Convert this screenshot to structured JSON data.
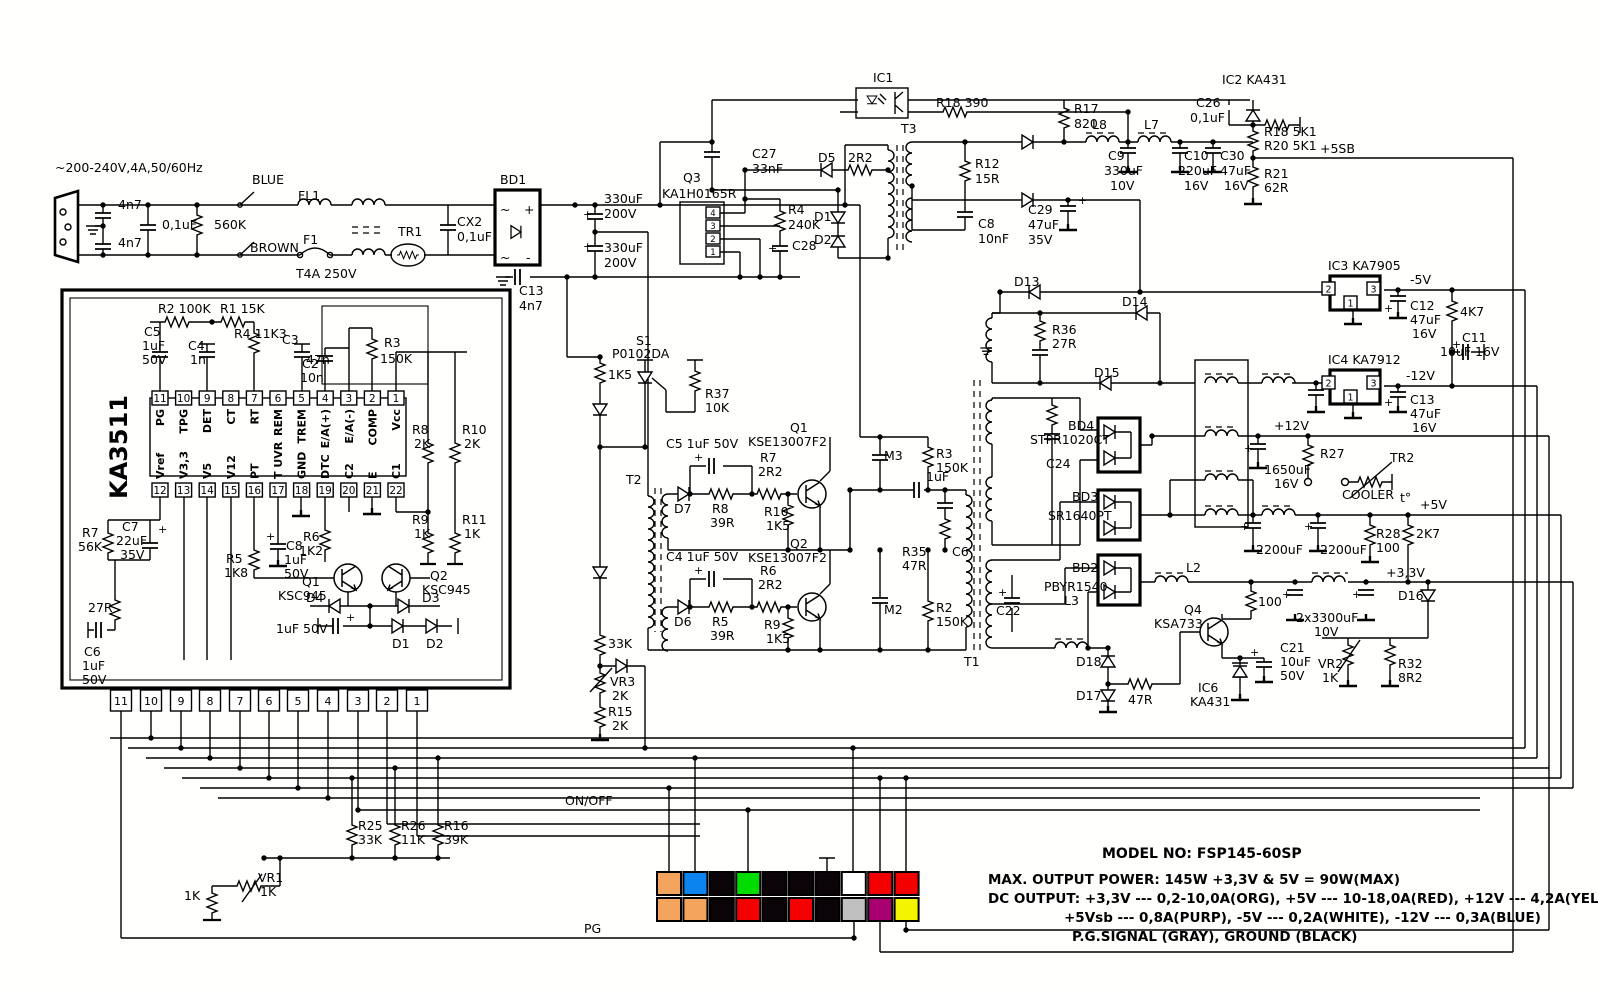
{
  "title": "FSP145-60SP switching power supply schematic",
  "colors": {
    "line": "#000000",
    "background": "#fffffe",
    "orange": "#F4A45C",
    "blue": "#0B84F0",
    "black": "#0A0408",
    "green": "#00DC00",
    "white": "#FFFFFF",
    "red": "#F40000",
    "gray": "#C0C0C0",
    "purple": "#A8006E",
    "yellow": "#F4F400"
  },
  "ka3511": {
    "part": "KA3511",
    "top_pins": [
      {
        "n": "11",
        "label": "PG"
      },
      {
        "n": "10",
        "label": "TPG"
      },
      {
        "n": "9",
        "label": "DET"
      },
      {
        "n": "8",
        "label": "CT"
      },
      {
        "n": "7",
        "label": "RT"
      },
      {
        "n": "6",
        "label": "REM"
      },
      {
        "n": "5",
        "label": "TREM"
      },
      {
        "n": "4",
        "label": "E/A(+)"
      },
      {
        "n": "3",
        "label": "E/A(-)"
      },
      {
        "n": "2",
        "label": "COMP"
      },
      {
        "n": "1",
        "label": "Vcc"
      }
    ],
    "bottom_pins": [
      {
        "n": "12",
        "label": "Vref"
      },
      {
        "n": "13",
        "label": "V3,3"
      },
      {
        "n": "14",
        "label": "V5"
      },
      {
        "n": "15",
        "label": "V12"
      },
      {
        "n": "16",
        "label": "PT"
      },
      {
        "n": "17",
        "label": "T UVR"
      },
      {
        "n": "18",
        "label": "GND"
      },
      {
        "n": "19",
        "label": "DTC"
      },
      {
        "n": "20",
        "label": "C2"
      },
      {
        "n": "21",
        "label": "E"
      },
      {
        "n": "22",
        "label": "C1"
      }
    ]
  },
  "board_connector_pins": [
    "11",
    "10",
    "9",
    "8",
    "7",
    "6",
    "5",
    "4",
    "3",
    "2",
    "1"
  ],
  "q3": {
    "name": "Q3",
    "part": "KA1H0165R",
    "pins": [
      "4",
      "3",
      "2",
      "1"
    ]
  },
  "regulators": {
    "ic3": {
      "name": "IC3 KA7905",
      "pins": [
        "2",
        "3",
        "1"
      ]
    },
    "ic4": {
      "name": "IC4 KA7912",
      "pins": [
        "2",
        "3",
        "1"
      ]
    }
  },
  "atx_connector": {
    "top_row": [
      "orange",
      "blue",
      "black",
      "green",
      "black",
      "black",
      "black",
      "white",
      "red",
      "red"
    ],
    "bottom_row": [
      "orange",
      "orange",
      "black",
      "red",
      "black",
      "red",
      "black",
      "gray",
      "purple",
      "yellow"
    ]
  },
  "info": {
    "model": "MODEL NO: FSP145-60SP",
    "line1": "MAX. OUTPUT POWER: 145W  +3,3V & 5V = 90W(MAX)",
    "line2": "DC OUTPUT: +3,3V --- 0,2-10,0A(ORG), +5V --- 10-18,0A(RED), +12V --- 4,2A(YEL)",
    "line3": "+5Vsb --- 0,8A(PURP), -5V --- 0,2A(WHITE), -12V --- 0,3A(BLUE)",
    "line4": "P.G.SIGNAL (GRAY), GROUND (BLACK)"
  },
  "labels": [
    {
      "t": "~200-240V,4A,50/60Hz",
      "x": 55,
      "y": 172
    },
    {
      "t": "4n7",
      "x": 118,
      "y": 209
    },
    {
      "t": "4n7",
      "x": 118,
      "y": 247
    },
    {
      "t": "0,1uF",
      "x": 162,
      "y": 229
    },
    {
      "t": "560K",
      "x": 214,
      "y": 229
    },
    {
      "t": "BLUE",
      "x": 252,
      "y": 184
    },
    {
      "t": "FL1",
      "x": 298,
      "y": 200
    },
    {
      "t": "BROWN",
      "x": 250,
      "y": 252
    },
    {
      "t": "F1",
      "x": 303,
      "y": 244
    },
    {
      "t": "T4A 250V",
      "x": 296,
      "y": 278
    },
    {
      "t": "TR1",
      "x": 398,
      "y": 236
    },
    {
      "t": "CX2",
      "x": 457,
      "y": 226
    },
    {
      "t": "0,1uF",
      "x": 457,
      "y": 241
    },
    {
      "t": "BD1",
      "x": 500,
      "y": 184
    },
    {
      "t": "~",
      "x": 500,
      "y": 214
    },
    {
      "t": "+",
      "x": 524,
      "y": 214
    },
    {
      "t": "~",
      "x": 500,
      "y": 262
    },
    {
      "t": "-",
      "x": 526,
      "y": 262
    },
    {
      "t": "330uF",
      "x": 604,
      "y": 203
    },
    {
      "t": "200V",
      "x": 604,
      "y": 218
    },
    {
      "t": "330uF",
      "x": 604,
      "y": 252
    },
    {
      "t": "200V",
      "x": 604,
      "y": 267
    },
    {
      "t": "+",
      "x": 583,
      "y": 218,
      "s": 11
    },
    {
      "t": "+",
      "x": 583,
      "y": 250,
      "s": 11
    },
    {
      "t": "C13",
      "x": 519,
      "y": 295
    },
    {
      "t": "4n7",
      "x": 519,
      "y": 310
    },
    {
      "t": "Q3",
      "x": 683,
      "y": 182
    },
    {
      "t": "KA1H0165R",
      "x": 662,
      "y": 198
    },
    {
      "t": "C27",
      "x": 752,
      "y": 158
    },
    {
      "t": "33nF",
      "x": 752,
      "y": 173
    },
    {
      "t": "R4",
      "x": 788,
      "y": 214
    },
    {
      "t": "240K",
      "x": 788,
      "y": 229
    },
    {
      "t": "C28",
      "x": 792,
      "y": 250
    },
    {
      "t": "+",
      "x": 768,
      "y": 252,
      "s": 11
    },
    {
      "t": "D5",
      "x": 818,
      "y": 162
    },
    {
      "t": "2R2",
      "x": 848,
      "y": 162
    },
    {
      "t": "D1",
      "x": 814,
      "y": 221
    },
    {
      "t": "D2",
      "x": 814,
      "y": 244
    },
    {
      "t": "T3",
      "x": 901,
      "y": 133
    },
    {
      "t": "IC1",
      "x": 873,
      "y": 82
    },
    {
      "t": "R18 390",
      "x": 936,
      "y": 107
    },
    {
      "t": "R12",
      "x": 975,
      "y": 168
    },
    {
      "t": "15R",
      "x": 975,
      "y": 183
    },
    {
      "t": "C8",
      "x": 978,
      "y": 228
    },
    {
      "t": "10nF",
      "x": 978,
      "y": 243
    },
    {
      "t": "R17",
      "x": 1074,
      "y": 113
    },
    {
      "t": "820",
      "x": 1074,
      "y": 128
    },
    {
      "t": "L8",
      "x": 1092,
      "y": 129
    },
    {
      "t": "C9",
      "x": 1108,
      "y": 160
    },
    {
      "t": "330uF",
      "x": 1104,
      "y": 175
    },
    {
      "t": "10V",
      "x": 1110,
      "y": 190
    },
    {
      "t": "L7",
      "x": 1144,
      "y": 129
    },
    {
      "t": "C10",
      "x": 1184,
      "y": 160
    },
    {
      "t": "220uF",
      "x": 1178,
      "y": 175
    },
    {
      "t": "16V",
      "x": 1184,
      "y": 190
    },
    {
      "t": "C30",
      "x": 1220,
      "y": 160
    },
    {
      "t": "47uF",
      "x": 1220,
      "y": 175
    },
    {
      "t": "16V",
      "x": 1224,
      "y": 190
    },
    {
      "t": "C29",
      "x": 1028,
      "y": 214
    },
    {
      "t": "47uF",
      "x": 1028,
      "y": 229
    },
    {
      "t": "35V",
      "x": 1028,
      "y": 244
    },
    {
      "t": "+",
      "x": 1078,
      "y": 204,
      "s": 11
    },
    {
      "t": "D13",
      "x": 1014,
      "y": 286
    },
    {
      "t": "IC2 KA431",
      "x": 1222,
      "y": 84
    },
    {
      "t": "C26",
      "x": 1196,
      "y": 107
    },
    {
      "t": "0,1uF",
      "x": 1190,
      "y": 122
    },
    {
      "t": "R18 5K1",
      "x": 1264,
      "y": 136
    },
    {
      "t": "R20 5K1",
      "x": 1264,
      "y": 150
    },
    {
      "t": "+5SB",
      "x": 1320,
      "y": 153
    },
    {
      "t": "R21",
      "x": 1264,
      "y": 178
    },
    {
      "t": "62R",
      "x": 1264,
      "y": 192
    },
    {
      "t": "R2 100K",
      "x": 158,
      "y": 313
    },
    {
      "t": "R1 15K",
      "x": 220,
      "y": 313
    },
    {
      "t": "C5",
      "x": 144,
      "y": 336
    },
    {
      "t": "1uF",
      "x": 142,
      "y": 350
    },
    {
      "t": "50V",
      "x": 142,
      "y": 364
    },
    {
      "t": "C4",
      "x": 188,
      "y": 350
    },
    {
      "t": "1n",
      "x": 190,
      "y": 364
    },
    {
      "t": "R4 11K3",
      "x": 234,
      "y": 338
    },
    {
      "t": "C3",
      "x": 282,
      "y": 344
    },
    {
      "t": "47n",
      "x": 306,
      "y": 364
    },
    {
      "t": "C2",
      "x": 302,
      "y": 368
    },
    {
      "t": "10n",
      "x": 300,
      "y": 382
    },
    {
      "t": "R3",
      "x": 384,
      "y": 347
    },
    {
      "t": "150K",
      "x": 380,
      "y": 363
    },
    {
      "t": "R8",
      "x": 412,
      "y": 434
    },
    {
      "t": "2K",
      "x": 414,
      "y": 448
    },
    {
      "t": "R10",
      "x": 462,
      "y": 434
    },
    {
      "t": "2K",
      "x": 464,
      "y": 448
    },
    {
      "t": "R9",
      "x": 412,
      "y": 524
    },
    {
      "t": "1K",
      "x": 414,
      "y": 538
    },
    {
      "t": "R11",
      "x": 462,
      "y": 524
    },
    {
      "t": "1K",
      "x": 464,
      "y": 538
    },
    {
      "t": "R7",
      "x": 82,
      "y": 537
    },
    {
      "t": "56K",
      "x": 78,
      "y": 551
    },
    {
      "t": "C7",
      "x": 122,
      "y": 531
    },
    {
      "t": "22uF",
      "x": 116,
      "y": 545
    },
    {
      "t": "35V",
      "x": 120,
      "y": 559
    },
    {
      "t": "+",
      "x": 158,
      "y": 533,
      "s": 11
    },
    {
      "t": "R5",
      "x": 226,
      "y": 563
    },
    {
      "t": "1K8",
      "x": 224,
      "y": 577
    },
    {
      "t": "C8",
      "x": 286,
      "y": 550
    },
    {
      "t": "1uF",
      "x": 284,
      "y": 564
    },
    {
      "t": "50V",
      "x": 284,
      "y": 578
    },
    {
      "t": "+",
      "x": 266,
      "y": 540,
      "s": 11
    },
    {
      "t": "R6",
      "x": 303,
      "y": 541
    },
    {
      "t": "1K2",
      "x": 299,
      "y": 555
    },
    {
      "t": "Q1",
      "x": 302,
      "y": 586
    },
    {
      "t": "KSC945",
      "x": 278,
      "y": 600
    },
    {
      "t": "D4",
      "x": 306,
      "y": 602
    },
    {
      "t": "1uF 50V",
      "x": 276,
      "y": 633
    },
    {
      "t": "+",
      "x": 346,
      "y": 621,
      "s": 11
    },
    {
      "t": "Q2",
      "x": 430,
      "y": 580
    },
    {
      "t": "KSC945",
      "x": 422,
      "y": 594
    },
    {
      "t": "D3",
      "x": 422,
      "y": 602
    },
    {
      "t": "D1",
      "x": 392,
      "y": 648
    },
    {
      "t": "D2",
      "x": 426,
      "y": 648
    },
    {
      "t": "27R",
      "x": 88,
      "y": 612
    },
    {
      "t": "C6",
      "x": 84,
      "y": 656
    },
    {
      "t": "1uF",
      "x": 82,
      "y": 670
    },
    {
      "t": "50V",
      "x": 82,
      "y": 684
    },
    {
      "t": "S1",
      "x": 636,
      "y": 345
    },
    {
      "t": "P0102DA",
      "x": 612,
      "y": 358
    },
    {
      "t": "1K5",
      "x": 608,
      "y": 379
    },
    {
      "t": "R37",
      "x": 705,
      "y": 398
    },
    {
      "t": "10K",
      "x": 705,
      "y": 412
    },
    {
      "t": "C5 1uF 50V",
      "x": 666,
      "y": 448
    },
    {
      "t": "+",
      "x": 694,
      "y": 461,
      "s": 11
    },
    {
      "t": "Q1",
      "x": 790,
      "y": 432
    },
    {
      "t": "KSE13007F2",
      "x": 748,
      "y": 446
    },
    {
      "t": "R7",
      "x": 760,
      "y": 462
    },
    {
      "t": "2R2",
      "x": 758,
      "y": 476
    },
    {
      "t": "T2",
      "x": 626,
      "y": 484
    },
    {
      "t": "D7",
      "x": 674,
      "y": 513
    },
    {
      "t": "R8",
      "x": 712,
      "y": 513
    },
    {
      "t": "39R",
      "x": 710,
      "y": 527
    },
    {
      "t": "R10",
      "x": 764,
      "y": 516
    },
    {
      "t": "1K5",
      "x": 766,
      "y": 530
    },
    {
      "t": "M3",
      "x": 884,
      "y": 460
    },
    {
      "t": "R3",
      "x": 936,
      "y": 458
    },
    {
      "t": "150K",
      "x": 936,
      "y": 472
    },
    {
      "t": "1uF",
      "x": 926,
      "y": 481
    },
    {
      "t": "R35",
      "x": 902,
      "y": 556
    },
    {
      "t": "47R",
      "x": 902,
      "y": 570
    },
    {
      "t": "C6",
      "x": 952,
      "y": 556
    },
    {
      "t": "C4 1uF 50V",
      "x": 666,
      "y": 561
    },
    {
      "t": "+",
      "x": 694,
      "y": 574,
      "s": 11
    },
    {
      "t": "Q2",
      "x": 790,
      "y": 548
    },
    {
      "t": "KSE13007F2",
      "x": 748,
      "y": 562
    },
    {
      "t": "R6",
      "x": 760,
      "y": 575
    },
    {
      "t": "2R2",
      "x": 758,
      "y": 589
    },
    {
      "t": "D6",
      "x": 674,
      "y": 626
    },
    {
      "t": "R5",
      "x": 712,
      "y": 626
    },
    {
      "t": "39R",
      "x": 710,
      "y": 640
    },
    {
      "t": "R9",
      "x": 764,
      "y": 629
    },
    {
      "t": "1K5",
      "x": 766,
      "y": 643
    },
    {
      "t": "M2",
      "x": 884,
      "y": 614
    },
    {
      "t": "R2",
      "x": 936,
      "y": 612
    },
    {
      "t": "150K",
      "x": 936,
      "y": 626
    },
    {
      "t": "33K",
      "x": 608,
      "y": 648
    },
    {
      "t": "VR3",
      "x": 610,
      "y": 686
    },
    {
      "t": "2K",
      "x": 612,
      "y": 700
    },
    {
      "t": "R15",
      "x": 608,
      "y": 716
    },
    {
      "t": "2K",
      "x": 612,
      "y": 730
    },
    {
      "t": "T1",
      "x": 964,
      "y": 666
    },
    {
      "t": "D14",
      "x": 1122,
      "y": 306
    },
    {
      "t": "R36",
      "x": 1052,
      "y": 334
    },
    {
      "t": "27R",
      "x": 1052,
      "y": 348
    },
    {
      "t": "D15",
      "x": 1094,
      "y": 377
    },
    {
      "t": "BD4",
      "x": 1068,
      "y": 430
    },
    {
      "t": "STPR1020CT",
      "x": 1030,
      "y": 444
    },
    {
      "t": "C24",
      "x": 1046,
      "y": 468
    },
    {
      "t": "BD3",
      "x": 1072,
      "y": 501
    },
    {
      "t": "SR1640PT",
      "x": 1048,
      "y": 520
    },
    {
      "t": "BD2",
      "x": 1072,
      "y": 572
    },
    {
      "t": "PBYR1540",
      "x": 1044,
      "y": 591
    },
    {
      "t": "L3",
      "x": 1064,
      "y": 605
    },
    {
      "t": "C22",
      "x": 996,
      "y": 615
    },
    {
      "t": "+",
      "x": 998,
      "y": 596,
      "s": 11
    },
    {
      "t": "L2",
      "x": 1186,
      "y": 572
    },
    {
      "t": "Q4",
      "x": 1184,
      "y": 614
    },
    {
      "t": "KSA733",
      "x": 1154,
      "y": 628
    },
    {
      "t": "IC3 KA7905",
      "x": 1328,
      "y": 270
    },
    {
      "t": "-5V",
      "x": 1410,
      "y": 284
    },
    {
      "t": "C12",
      "x": 1410,
      "y": 310
    },
    {
      "t": "47uF",
      "x": 1410,
      "y": 324
    },
    {
      "t": "16V",
      "x": 1412,
      "y": 338
    },
    {
      "t": "+",
      "x": 1384,
      "y": 312,
      "s": 11
    },
    {
      "t": "4K7",
      "x": 1460,
      "y": 316
    },
    {
      "t": "C11",
      "x": 1462,
      "y": 342
    },
    {
      "t": "10uF 16V",
      "x": 1440,
      "y": 356
    },
    {
      "t": "+",
      "x": 1452,
      "y": 348,
      "s": 11
    },
    {
      "t": "IC4 KA7912",
      "x": 1328,
      "y": 364
    },
    {
      "t": "-12V",
      "x": 1406,
      "y": 380
    },
    {
      "t": "C13",
      "x": 1410,
      "y": 404
    },
    {
      "t": "47uF",
      "x": 1410,
      "y": 418
    },
    {
      "t": "16V",
      "x": 1412,
      "y": 432
    },
    {
      "t": "+",
      "x": 1384,
      "y": 406,
      "s": 11
    },
    {
      "t": "+12V",
      "x": 1274,
      "y": 430
    },
    {
      "t": "1650uF",
      "x": 1264,
      "y": 474
    },
    {
      "t": "16V",
      "x": 1274,
      "y": 488
    },
    {
      "t": "+",
      "x": 1244,
      "y": 452,
      "s": 11
    },
    {
      "t": "R27",
      "x": 1320,
      "y": 458
    },
    {
      "t": "TR2",
      "x": 1390,
      "y": 462
    },
    {
      "t": "COOLER",
      "x": 1342,
      "y": 499
    },
    {
      "t": "t°",
      "x": 1400,
      "y": 502
    },
    {
      "t": "+5V",
      "x": 1420,
      "y": 509
    },
    {
      "t": "2200uF",
      "x": 1256,
      "y": 554
    },
    {
      "t": "2200uF",
      "x": 1320,
      "y": 554
    },
    {
      "t": "+",
      "x": 1240,
      "y": 530,
      "s": 11
    },
    {
      "t": "+",
      "x": 1304,
      "y": 530,
      "s": 11
    },
    {
      "t": "R28",
      "x": 1376,
      "y": 538
    },
    {
      "t": "100",
      "x": 1376,
      "y": 552
    },
    {
      "t": "2K7",
      "x": 1416,
      "y": 538
    },
    {
      "t": "+3,3V",
      "x": 1386,
      "y": 577
    },
    {
      "t": "D16",
      "x": 1398,
      "y": 600
    },
    {
      "t": "100",
      "x": 1258,
      "y": 606
    },
    {
      "t": "2x3300uF",
      "x": 1296,
      "y": 622
    },
    {
      "t": "10V",
      "x": 1314,
      "y": 636
    },
    {
      "t": "+",
      "x": 1282,
      "y": 598,
      "s": 11
    },
    {
      "t": "+",
      "x": 1352,
      "y": 598,
      "s": 11
    },
    {
      "t": "C21",
      "x": 1280,
      "y": 652
    },
    {
      "t": "10uF",
      "x": 1280,
      "y": 666
    },
    {
      "t": "50V",
      "x": 1280,
      "y": 680
    },
    {
      "t": "+",
      "x": 1250,
      "y": 656,
      "s": 11
    },
    {
      "t": "VR2",
      "x": 1318,
      "y": 668
    },
    {
      "t": "1K",
      "x": 1322,
      "y": 682
    },
    {
      "t": "R32",
      "x": 1398,
      "y": 668
    },
    {
      "t": "8R2",
      "x": 1398,
      "y": 682
    },
    {
      "t": "D18",
      "x": 1076,
      "y": 666
    },
    {
      "t": "D17",
      "x": 1076,
      "y": 700
    },
    {
      "t": "47R",
      "x": 1128,
      "y": 704
    },
    {
      "t": "IC6",
      "x": 1198,
      "y": 692
    },
    {
      "t": "KA431",
      "x": 1190,
      "y": 706
    },
    {
      "t": "ON/OFF",
      "x": 565,
      "y": 805
    },
    {
      "t": "R25",
      "x": 358,
      "y": 830
    },
    {
      "t": "33K",
      "x": 358,
      "y": 844
    },
    {
      "t": "R26",
      "x": 401,
      "y": 830
    },
    {
      "t": "11K",
      "x": 401,
      "y": 844
    },
    {
      "t": "R16",
      "x": 444,
      "y": 830
    },
    {
      "t": "39K",
      "x": 444,
      "y": 844
    },
    {
      "t": "VR1",
      "x": 258,
      "y": 882
    },
    {
      "t": "1K",
      "x": 260,
      "y": 896
    },
    {
      "t": "1K",
      "x": 184,
      "y": 900
    },
    {
      "t": "PG",
      "x": 584,
      "y": 933
    },
    {
      "t": "MODEL NO: FSP145-60SP",
      "x": 1102,
      "y": 858,
      "s": 14,
      "b": 1
    },
    {
      "t": "MAX. OUTPUT POWER: 145W  +3,3V & 5V = 90W(MAX)",
      "x": 988,
      "y": 884,
      "s": 13.5,
      "b": 1
    },
    {
      "t": "DC OUTPUT: +3,3V --- 0,2-10,0A(ORG), +5V --- 10-18,0A(RED), +12V --- 4,2A(YEL)",
      "x": 988,
      "y": 903,
      "s": 13.5,
      "b": 1
    },
    {
      "t": "+5Vsb --- 0,8A(PURP), -5V --- 0,2A(WHITE), -12V --- 0,3A(BLUE)",
      "x": 1064,
      "y": 922,
      "s": 13.5,
      "b": 1
    },
    {
      "t": "P.G.SIGNAL (GRAY), GROUND (BLACK)",
      "x": 1072,
      "y": 941,
      "s": 13.5,
      "b": 1
    }
  ]
}
